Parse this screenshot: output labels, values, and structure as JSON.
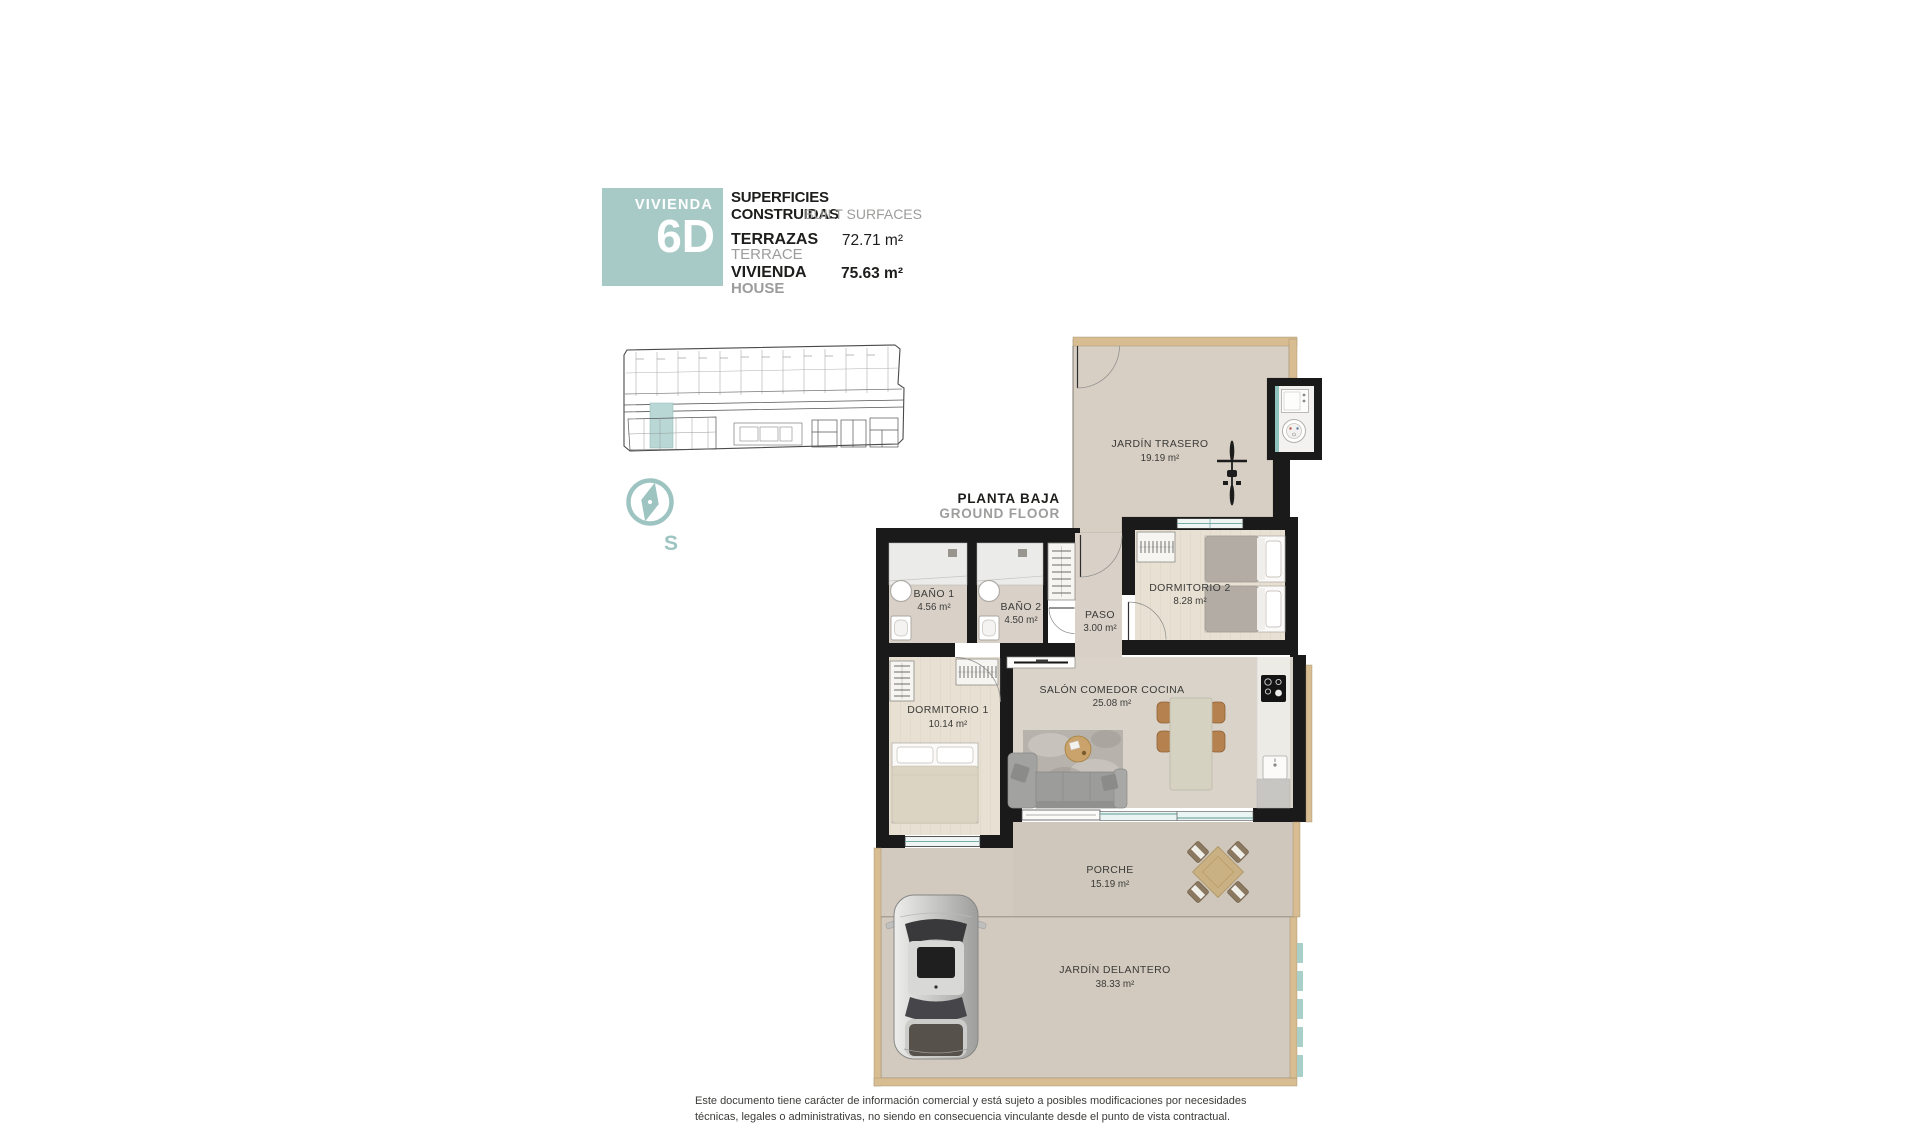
{
  "header": {
    "unit_label": "VIVIENDA",
    "unit_number": "6D",
    "surfaces_title": "SUPERFICIES CONSTRUIDAS",
    "surfaces_title_en": "BUILT SURFACES",
    "terrace_label": "TERRAZAS",
    "terrace_label_en": "TERRACE",
    "terrace_value": "72.71 m²",
    "house_label": "VIVIENDA",
    "house_label_en": "HOUSE",
    "house_value": "75.63 m²"
  },
  "floor_label": {
    "es": "PLANTA BAJA",
    "en": "GROUND FLOOR"
  },
  "compass": {
    "letter": "S"
  },
  "site_plan": {
    "highlight_color": "#b9d8d5"
  },
  "rooms": {
    "jardin_trasero": {
      "name": "JARDÍN TRASERO",
      "area": "19.19 m²"
    },
    "bano1": {
      "name": "BAÑO 1",
      "area": "4.56 m²"
    },
    "bano2": {
      "name": "BAÑO 2",
      "area": "4.50 m²"
    },
    "paso": {
      "name": "PASO",
      "area": "3.00 m²"
    },
    "dormitorio2": {
      "name": "DORMITORIO 2",
      "area": "8.28 m²"
    },
    "dormitorio1": {
      "name": "DORMITORIO 1",
      "area": "10.14 m²"
    },
    "salon": {
      "name": "SALÓN COMEDOR COCINA",
      "area": "25.08 m²"
    },
    "porche": {
      "name": "PORCHE",
      "area": "15.19 m²"
    },
    "jardin_delantero": {
      "name": "JARDÍN DELANTERO",
      "area": "38.33 m²"
    }
  },
  "footer": {
    "line1": "Este documento tiene carácter de información comercial y está sujeto a posibles modificaciones por necesidades",
    "line2": "técnicas, legales o administrativas, no siendo en consecuencia vinculante desde el punto de vista contractual."
  },
  "colors": {
    "accent_teal": "#a8cac7",
    "window_teal": "#8fc1bd",
    "wall_black": "#1a1a1a",
    "tan_border": "#d8bd92",
    "back_garden": "#d7cec4",
    "front_garden": "#d3cabf",
    "interior_floor": "#dad3ca",
    "wood_floor": "#e8e0d2"
  }
}
